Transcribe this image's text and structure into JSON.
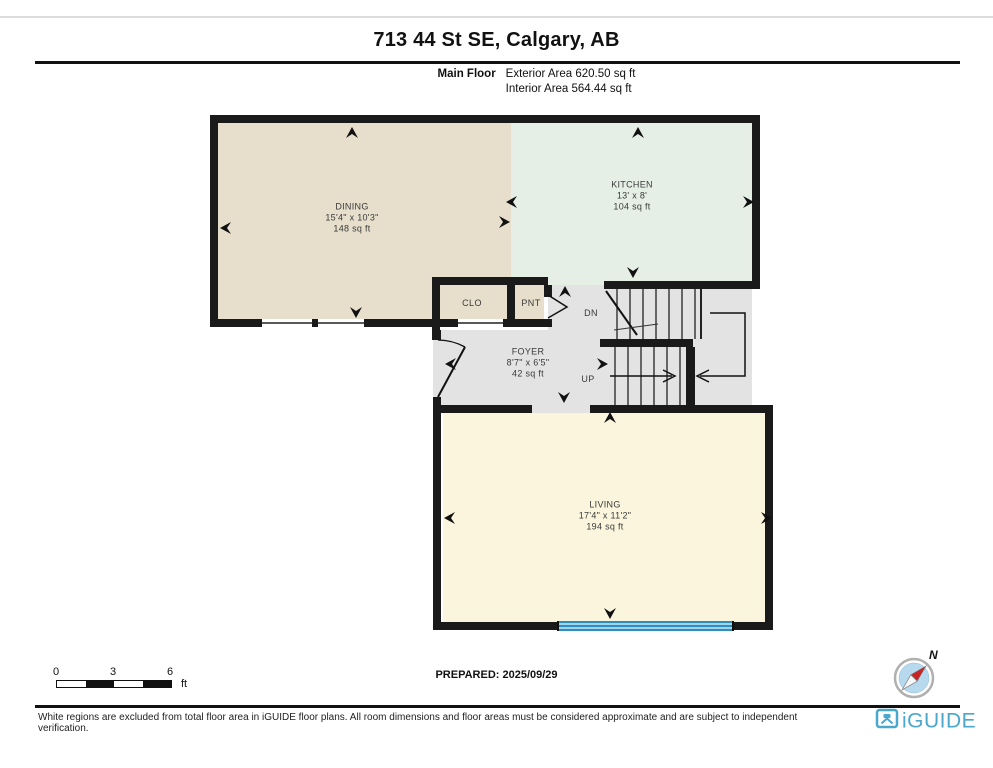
{
  "header": {
    "title": "713 44 St SE, Calgary, AB",
    "floor_label": "Main Floor",
    "exterior_area": "Exterior Area 620.50 sq ft",
    "interior_area": "Interior Area 564.44 sq ft"
  },
  "rooms": {
    "dining": {
      "name": "DINING",
      "dims": "15'4\" x 10'3\"",
      "area": "148 sq ft"
    },
    "kitchen": {
      "name": "KITCHEN",
      "dims": "13' x 8'",
      "area": "104 sq ft"
    },
    "closet": {
      "name": "CLO"
    },
    "pantry": {
      "name": "PNT"
    },
    "foyer": {
      "name": "FOYER",
      "dims": "8'7\" x 6'5\"",
      "area": "42 sq ft"
    },
    "living": {
      "name": "LIVING",
      "dims": "17'4\" x 11'2\"",
      "area": "194 sq ft"
    }
  },
  "stairs": {
    "down": "DN",
    "up": "UP"
  },
  "scale": {
    "ticks": [
      "0",
      "3",
      "6"
    ],
    "unit": "ft"
  },
  "prepared_label": "PREPARED: 2025/09/29",
  "compass": {
    "north_label": "N"
  },
  "footer": {
    "disclaimer": "White regions are excluded from total floor area in iGUIDE floor plans. All room dimensions and floor areas must be considered approximate and are subject to independent verification.",
    "brand": "iGUIDE"
  },
  "colors": {
    "dining_fill": "#e7dfcc",
    "kitchen_fill": "#e5efe6",
    "foyer_fill": "#e3e3e3",
    "living_fill": "#faf5dc",
    "wall": "#1a1a1a",
    "patio_door_blue": "#2f8fbc",
    "brand_blue": "#4aa7cd",
    "compass_blue": "#b7d9ee",
    "needle_red": "#cc2222"
  }
}
